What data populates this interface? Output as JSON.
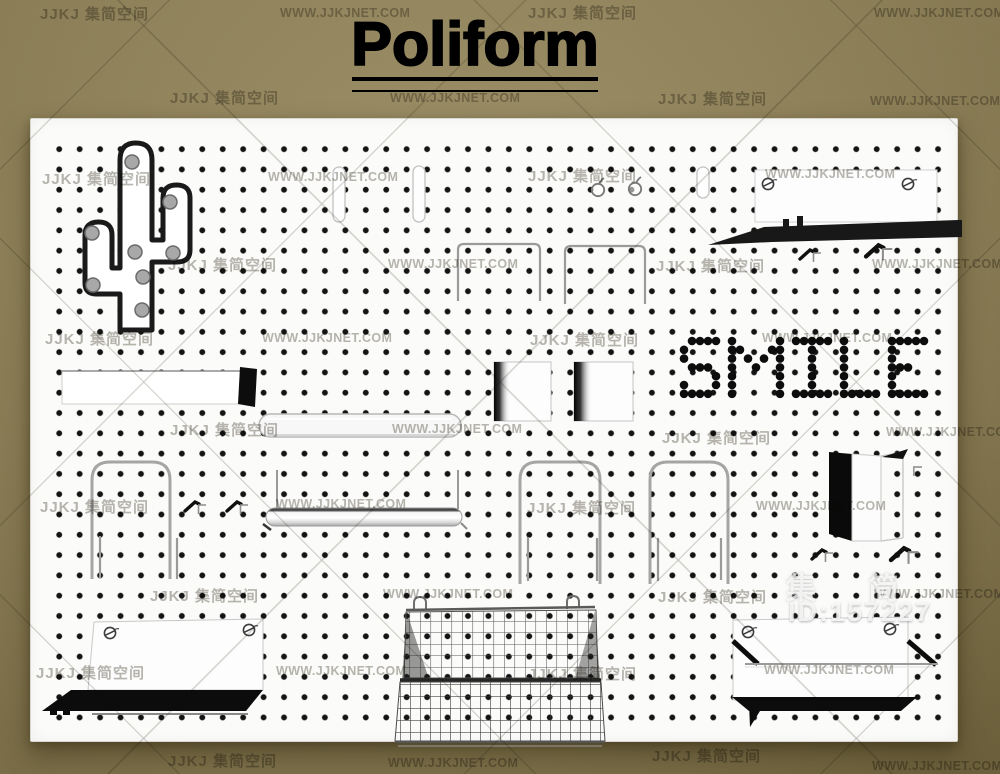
{
  "title": {
    "text": "Poliform"
  },
  "watermarks": {
    "site_name_cn": "JJKJ 集简空间",
    "site_url": "WWW.JJKJNET.COM",
    "id_brand": "集 简",
    "id_number": "ID:157227",
    "tiles": [
      {
        "type": "cn",
        "x": 40,
        "y": 3
      },
      {
        "type": "url",
        "x": 280,
        "y": 6
      },
      {
        "type": "cn",
        "x": 528,
        "y": 2
      },
      {
        "type": "url",
        "x": 874,
        "y": 6
      },
      {
        "type": "cn",
        "x": 170,
        "y": 87
      },
      {
        "type": "url",
        "x": 390,
        "y": 91
      },
      {
        "type": "cn",
        "x": 658,
        "y": 88
      },
      {
        "type": "url",
        "x": 870,
        "y": 94
      },
      {
        "type": "cn",
        "x": 42,
        "y": 168
      },
      {
        "type": "url",
        "x": 268,
        "y": 170
      },
      {
        "type": "cn",
        "x": 528,
        "y": 165
      },
      {
        "type": "url",
        "x": 765,
        "y": 167
      },
      {
        "type": "cn",
        "x": 168,
        "y": 254
      },
      {
        "type": "url",
        "x": 388,
        "y": 257
      },
      {
        "type": "cn",
        "x": 656,
        "y": 255
      },
      {
        "type": "url",
        "x": 872,
        "y": 257
      },
      {
        "type": "cn",
        "x": 45,
        "y": 328
      },
      {
        "type": "url",
        "x": 262,
        "y": 331
      },
      {
        "type": "cn",
        "x": 530,
        "y": 329
      },
      {
        "type": "url",
        "x": 762,
        "y": 331
      },
      {
        "type": "cn",
        "x": 170,
        "y": 419
      },
      {
        "type": "url",
        "x": 392,
        "y": 422
      },
      {
        "type": "cn",
        "x": 662,
        "y": 427
      },
      {
        "type": "url",
        "x": 886,
        "y": 425
      },
      {
        "type": "cn",
        "x": 40,
        "y": 496
      },
      {
        "type": "url",
        "x": 276,
        "y": 497
      },
      {
        "type": "cn",
        "x": 527,
        "y": 497
      },
      {
        "type": "url",
        "x": 756,
        "y": 499
      },
      {
        "type": "cn",
        "x": 150,
        "y": 585
      },
      {
        "type": "url",
        "x": 383,
        "y": 587
      },
      {
        "type": "cn",
        "x": 658,
        "y": 586
      },
      {
        "type": "url",
        "x": 874,
        "y": 587
      },
      {
        "type": "cn",
        "x": 36,
        "y": 662
      },
      {
        "type": "url",
        "x": 276,
        "y": 664
      },
      {
        "type": "cn",
        "x": 528,
        "y": 663
      },
      {
        "type": "url",
        "x": 764,
        "y": 663
      },
      {
        "type": "cn",
        "x": 168,
        "y": 750
      },
      {
        "type": "url",
        "x": 388,
        "y": 756
      },
      {
        "type": "cn",
        "x": 652,
        "y": 745
      },
      {
        "type": "url",
        "x": 872,
        "y": 759
      }
    ]
  },
  "smile": {
    "word": "SMILE",
    "x": 684,
    "y": 341,
    "col_step": 8,
    "row_step": 8.8,
    "dot_radius": 4.3,
    "letter_gap": 16,
    "dot_color": "#0d0d0d",
    "letters": {
      "S": [
        "01111",
        "10000",
        "10000",
        "01110",
        "00001",
        "10001",
        "11110"
      ],
      "M": [
        "1000001",
        "1100011",
        "1010101",
        "1001001",
        "1000001",
        "1000001",
        "1000001"
      ],
      "I": [
        "11111",
        "00100",
        "00100",
        "00100",
        "00100",
        "00100",
        "11111"
      ],
      "L": [
        "10000",
        "10000",
        "10000",
        "10000",
        "10000",
        "10000",
        "11111"
      ],
      "E": [
        "11111",
        "10000",
        "10000",
        "11100",
        "10000",
        "10000",
        "11111"
      ]
    }
  },
  "pegboard_items": [
    "cactus-peg-decoration",
    "mounting-slots",
    "round-hooks",
    "sign-panel-top-right",
    "black-wedge-shelf",
    "wire-arches",
    "smile-peg-letters",
    "shelf-board-black-end",
    "pill-shelf",
    "square-bookends",
    "wire-loop-hooks",
    "peg-hooks",
    "rod-rail-shelf",
    "open-storage-box",
    "shelf-unit-bottom-left",
    "wire-basket",
    "shelf-unit-bottom-right"
  ],
  "colors": {
    "background_khaki": "#998b60",
    "board_white": "#fbfbf9",
    "peg_hole_black": "#141414",
    "smile_dot_black": "#0d0d0d",
    "cactus_outline": "#1a1a1a",
    "peg_gray": "#a8a8a8",
    "accent_black": "#0c0c0c",
    "wire_gray": "#a5a5a5",
    "watermark_gray": "#787569",
    "id_watermark_white": "#fafafa"
  }
}
